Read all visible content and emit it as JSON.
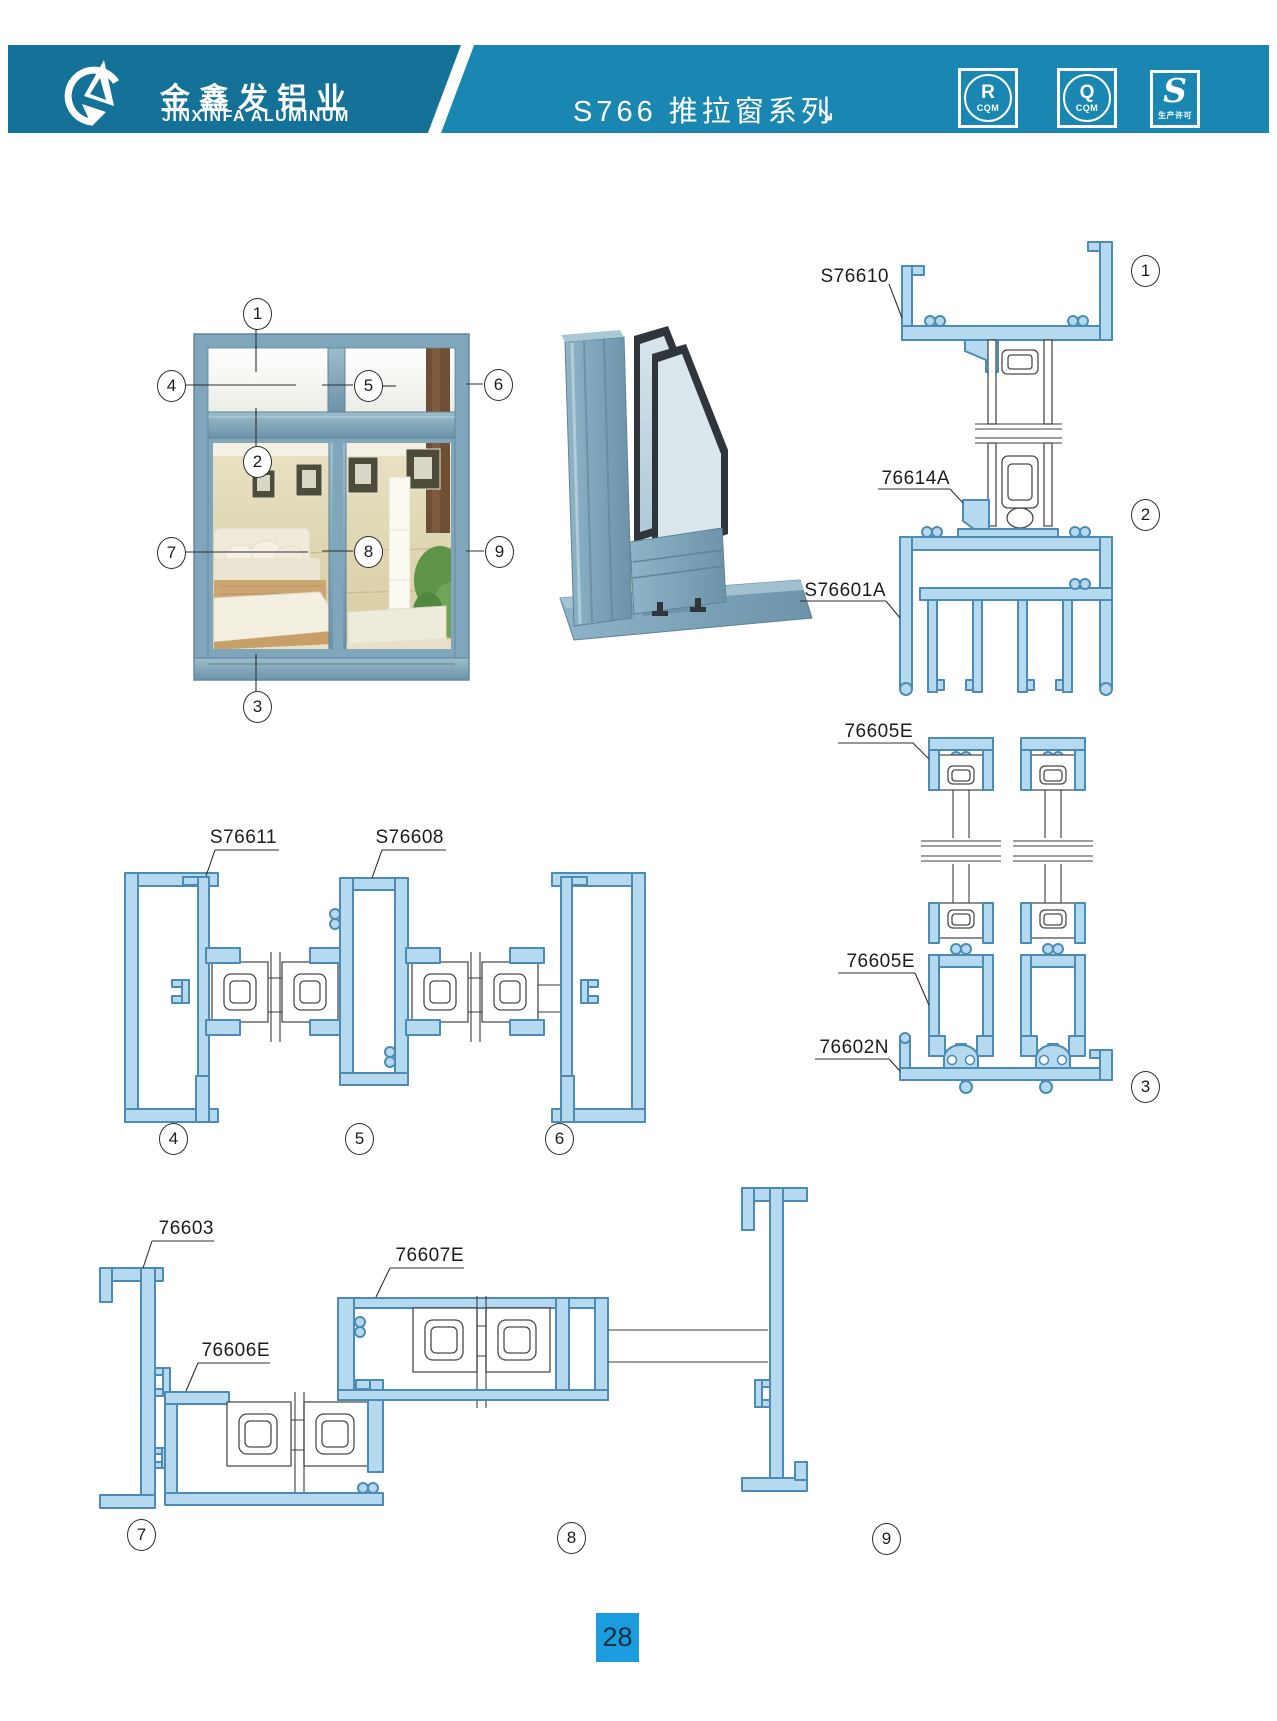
{
  "header": {
    "company_cn": "金鑫发铝业",
    "company_en": "JINXINFA ALUMINUM",
    "series_title": "S766 推拉窗系列",
    "arrow_glyph": "↘",
    "badges": [
      {
        "letter": "R",
        "caption": "CQM"
      },
      {
        "letter": "Q",
        "caption": "CQM"
      },
      {
        "letter": "S",
        "caption": "生产许可"
      }
    ]
  },
  "drawings": {
    "vertical_section_labels": [
      "S76610",
      "76614A",
      "S76601A",
      "76605E",
      "76605E",
      "76602N"
    ],
    "horizontal_mid_labels": [
      "S76611",
      "S76608"
    ],
    "horizontal_bottom_labels": [
      "76603",
      "76607E",
      "76606E"
    ]
  },
  "callouts": {
    "numbers": [
      "1",
      "2",
      "3",
      "4",
      "5",
      "6",
      "7",
      "8",
      "9"
    ]
  },
  "page_number": "28",
  "colors": {
    "header_left": "#147197",
    "header_right": "#1A87B2",
    "page_badge": "#1B9CDE",
    "profile_fill": "#B5D9EE",
    "profile_stroke": "#4C8CB4",
    "photo_frame": "#7FA6BA"
  }
}
